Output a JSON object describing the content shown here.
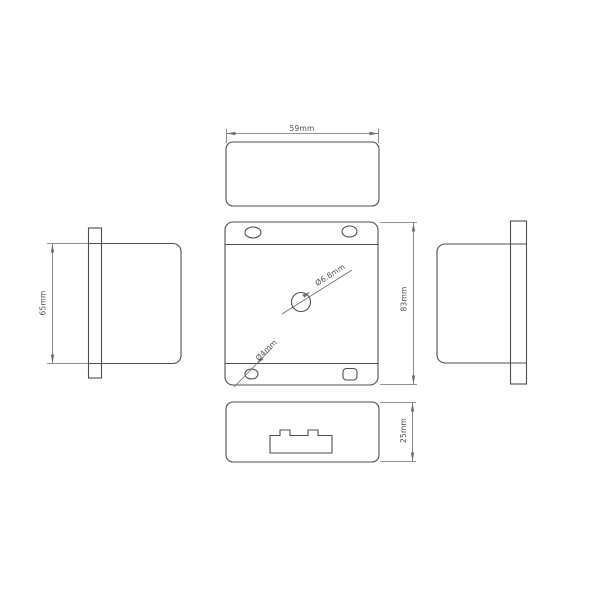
{
  "drawing": {
    "background": "#ffffff",
    "colors": {
      "outline": "#4f4f4f",
      "dimension": "#6e6e6e",
      "text": "#4d4d4d"
    },
    "top_view": {
      "width_label": "59mm"
    },
    "front_view": {
      "height_label": "83mm",
      "center_hole_label": "Ø6.8mm",
      "mounting_hole_label": "Ø4mm"
    },
    "left_view": {
      "height_label": "65mm"
    },
    "bottom_view": {
      "depth_label": "25mm"
    }
  }
}
